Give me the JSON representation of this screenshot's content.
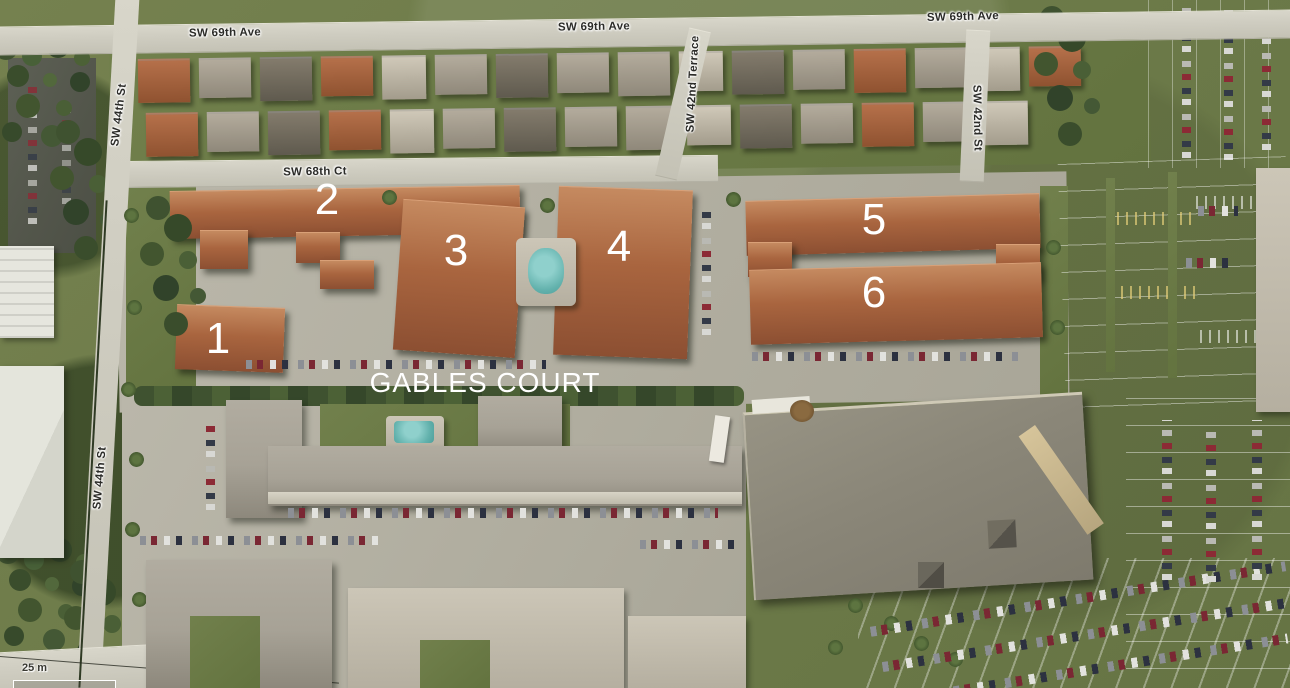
{
  "map": {
    "description": "Bird's-eye aerial photo of the Gables Court apartment complex and surrounding streets",
    "complex_label": {
      "text": "GABLES COURT"
    },
    "scale_bar": {
      "label": "25 m"
    },
    "street_labels": [
      {
        "id": "sw-69th-ave-west",
        "text": "SW 69th Ave"
      },
      {
        "id": "sw-69th-ave-center",
        "text": "SW 69th Ave"
      },
      {
        "id": "sw-69th-ave-east",
        "text": "SW 69th Ave"
      },
      {
        "id": "sw-68th-ct",
        "text": "SW 68th Ct"
      },
      {
        "id": "sw-44th-st-north",
        "text": "SW 44th St"
      },
      {
        "id": "sw-44th-st-south",
        "text": "SW 44th St"
      },
      {
        "id": "sw-42nd-terrace",
        "text": "SW 42nd Terrace"
      },
      {
        "id": "sw-42nd-st",
        "text": "SW 42nd St"
      }
    ],
    "building_markers": [
      {
        "number": "1"
      },
      {
        "number": "2"
      },
      {
        "number": "3"
      },
      {
        "number": "4"
      },
      {
        "number": "5"
      },
      {
        "number": "6"
      }
    ],
    "colors": {
      "marker_text": "#ffffff",
      "street_label_text": "#2b2b28",
      "street_label_halo": "#ffffff",
      "road": "#cfcdc1",
      "grass": "#6e7c4a",
      "trees": "#3f5230",
      "terracotta_roof": "#a9653f",
      "gray_roof": "#a7a296",
      "asphalt_dark": "#55584e",
      "pool_water": "#62b1ac",
      "store_roof": "#8a8678"
    }
  }
}
